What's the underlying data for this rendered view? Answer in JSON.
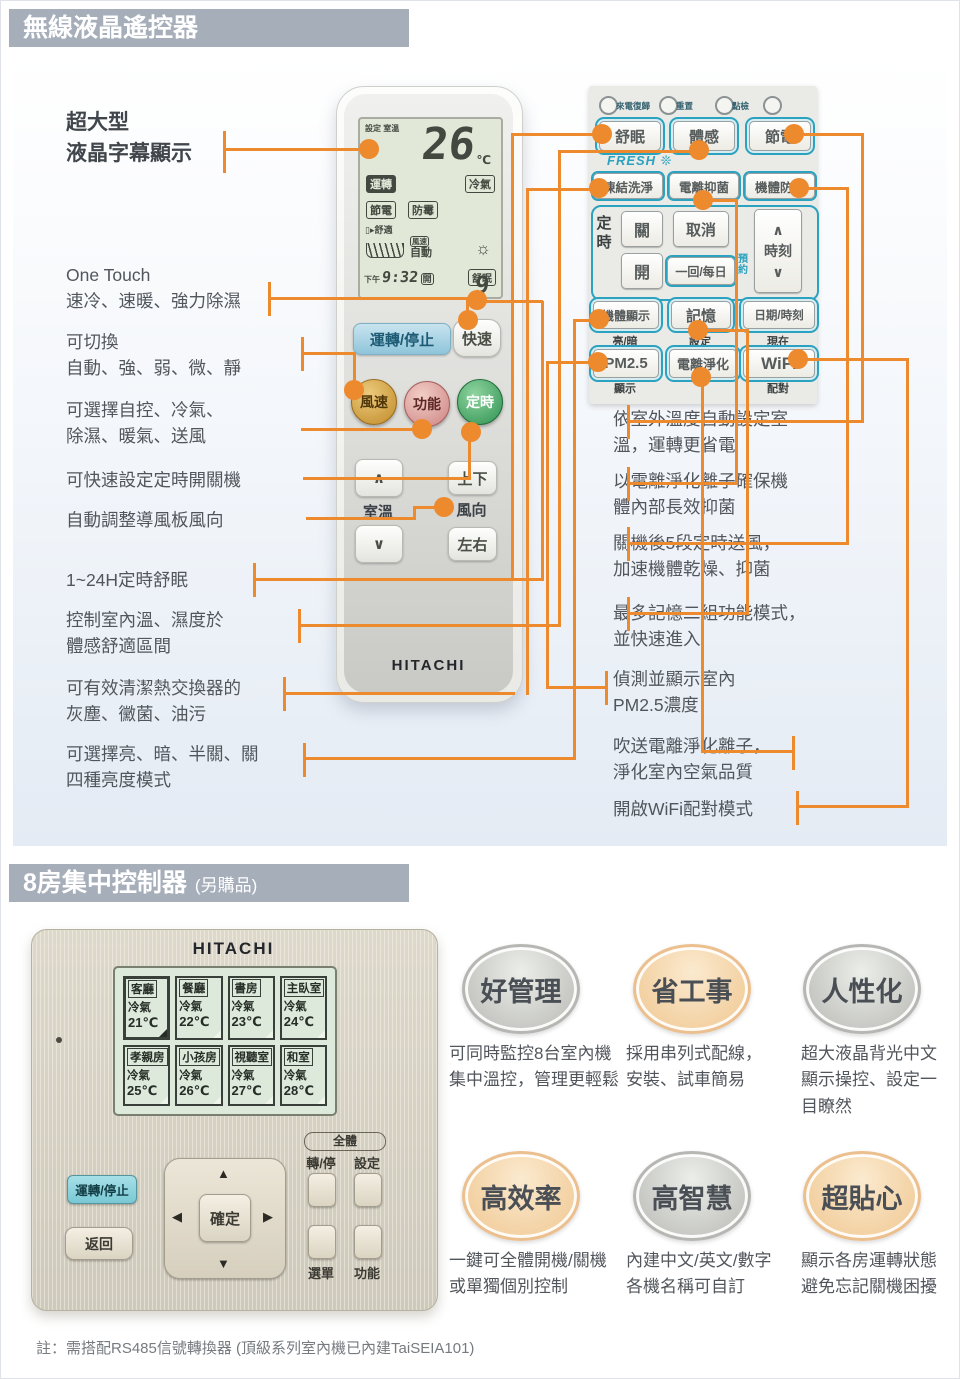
{
  "colors": {
    "accent_orange": "#ED8A2D",
    "header_gray": "#A6AEBA",
    "cyan": "#2BA2BF",
    "lcd_green": "#E2E8D8",
    "controller_beige": "#D6D0C1"
  },
  "icons": {
    "up_triangle": "▲",
    "down_triangle": "▼",
    "left_triangle": "◀",
    "right_triangle": "▶",
    "chevron_up": "∧",
    "chevron_down": "∨",
    "sun": "☼",
    "snowflake": "❊"
  },
  "section1": {
    "header": "無線液晶遙控器",
    "left_labels": [
      {
        "bold": true,
        "lines": [
          "超大型",
          "液晶字幕顯示"
        ]
      },
      {
        "bold": false,
        "lines": [
          "One Touch",
          "速冷、速暖、強力除濕"
        ]
      },
      {
        "bold": false,
        "lines": [
          "可切換",
          "自動、強、弱、微、靜"
        ]
      },
      {
        "bold": false,
        "lines": [
          "可選擇自控、冷氣、",
          "除濕、暖氣、送風"
        ]
      },
      {
        "bold": false,
        "lines": [
          "可快速設定定時開關機"
        ]
      },
      {
        "bold": false,
        "lines": [
          "自動調整導風板風向"
        ]
      },
      {
        "bold": false,
        "lines": [
          "1~24H定時舒眠"
        ]
      },
      {
        "bold": false,
        "lines": [
          "控制室內溫、濕度於",
          "體感舒適區間"
        ]
      },
      {
        "bold": false,
        "lines": [
          "可有效清潔熱交換器的",
          "灰塵、黴菌、油污"
        ]
      },
      {
        "bold": false,
        "lines": [
          "可選擇亮、暗、半關、關",
          "四種亮度模式"
        ]
      }
    ],
    "remote": {
      "brand": "HITACHI",
      "lcd": {
        "set_label": "設定",
        "room_label": "室溫",
        "temp": "26",
        "temp_unit": "℃",
        "run": "運轉",
        "mode": "冷氣",
        "badge_energy": "節電",
        "badge_mold": "防霉",
        "comfort": "舒適",
        "fan": "風速",
        "auto": "自動",
        "ampm": "下午",
        "time": "9:32",
        "on_label": "開",
        "sleep": "舒眠",
        "sleep_digit": "9"
      },
      "buttons": {
        "power": "運轉/停止",
        "quick": "快速",
        "fan": "風速",
        "func": "功能",
        "timer": "定時",
        "up": "∧",
        "down": "∨",
        "room_temp": "室溫",
        "updown": "上下",
        "wind": "風向",
        "leftright": "左右"
      }
    },
    "panel": {
      "leds": [
        "來電復歸",
        "重置",
        "點檢"
      ],
      "row1": [
        "舒眠",
        "體感",
        "節電"
      ],
      "fresh_label": "FRESH ❊",
      "row2": [
        "凍結洗淨",
        "電離抑菌",
        "機體防霉"
      ],
      "timer_group": {
        "label": "定時",
        "off": "關",
        "cancel": "取消",
        "on": "開",
        "once_daily": "一回/每日",
        "reserve": "預約",
        "time_label": "時刻"
      },
      "row3": [
        {
          "label": "機體顯示",
          "sub": "亮/暗"
        },
        {
          "label": "記憶",
          "sub": "設定"
        },
        {
          "label": "日期/時刻",
          "sub": "現在"
        }
      ],
      "row4": [
        {
          "label": "PM2.5",
          "sub": "顯示"
        },
        {
          "label": "電離淨化",
          "sub": ""
        },
        {
          "label": "WiFi",
          "sub": "配對"
        }
      ]
    },
    "right_descriptions": [
      {
        "lines": [
          "依室外溫度自動設定室",
          "溫，運轉更省電"
        ]
      },
      {
        "lines": [
          "以電離淨化離子確保機",
          "體內部長效抑菌"
        ]
      },
      {
        "lines": [
          "關機後5段定時送風，",
          "加速機體乾燥、抑菌"
        ]
      },
      {
        "lines": [
          "最多記憶二組功能模式，",
          "並快速進入"
        ]
      },
      {
        "lines": [
          "偵測並顯示室內",
          "PM2.5濃度"
        ]
      },
      {
        "lines": [
          "吹送電離淨化離子，",
          "淨化室內空氣品質"
        ]
      },
      {
        "lines": [
          "開啟WiFi配對模式"
        ]
      }
    ]
  },
  "section2": {
    "header": "8房集中控制器",
    "header_suffix": "(另購品)",
    "controller": {
      "brand": "HITACHI",
      "rooms": [
        {
          "name": "客廳",
          "mode": "冷氣",
          "temp": "21℃"
        },
        {
          "name": "餐廳",
          "mode": "冷氣",
          "temp": "22℃"
        },
        {
          "name": "書房",
          "mode": "冷氣",
          "temp": "23℃"
        },
        {
          "name": "主臥室",
          "mode": "冷氣",
          "temp": "24℃"
        },
        {
          "name": "孝親房",
          "mode": "冷氣",
          "temp": "25℃"
        },
        {
          "name": "小孩房",
          "mode": "冷氣",
          "temp": "26℃"
        },
        {
          "name": "視聽室",
          "mode": "冷氣",
          "temp": "27℃"
        },
        {
          "name": "和室",
          "mode": "冷氣",
          "temp": "28℃"
        }
      ],
      "buttons": {
        "power": "運轉/停止",
        "back": "返回",
        "ok": "確定",
        "all": "全體",
        "run_stop": "轉/停",
        "set": "設定",
        "menu": "選單",
        "func": "功能"
      }
    },
    "features": [
      {
        "title": "好管理",
        "style": "gray",
        "lines": [
          "可同時監控8台室內機",
          "集中溫控，管理更輕鬆"
        ]
      },
      {
        "title": "省工事",
        "style": "peach",
        "lines": [
          "採用串列式配線，",
          "安裝、試車簡易"
        ]
      },
      {
        "title": "人性化",
        "style": "gray",
        "lines": [
          "超大液晶背光中文",
          "顯示操控、設定一",
          "目瞭然"
        ]
      },
      {
        "title": "高效率",
        "style": "peach",
        "lines": [
          "一鍵可全體開機/關機",
          "或單獨個別控制"
        ]
      },
      {
        "title": "高智慧",
        "style": "gray",
        "lines": [
          "內建中文/英文/數字",
          "各機名稱可自訂"
        ]
      },
      {
        "title": "超貼心",
        "style": "peach",
        "lines": [
          "顯示各房運轉狀態",
          "避免忘記關機困擾"
        ]
      }
    ],
    "note": "註：需搭配RS485信號轉換器 (頂級系列室內機已內建TaiSEIA101)"
  }
}
